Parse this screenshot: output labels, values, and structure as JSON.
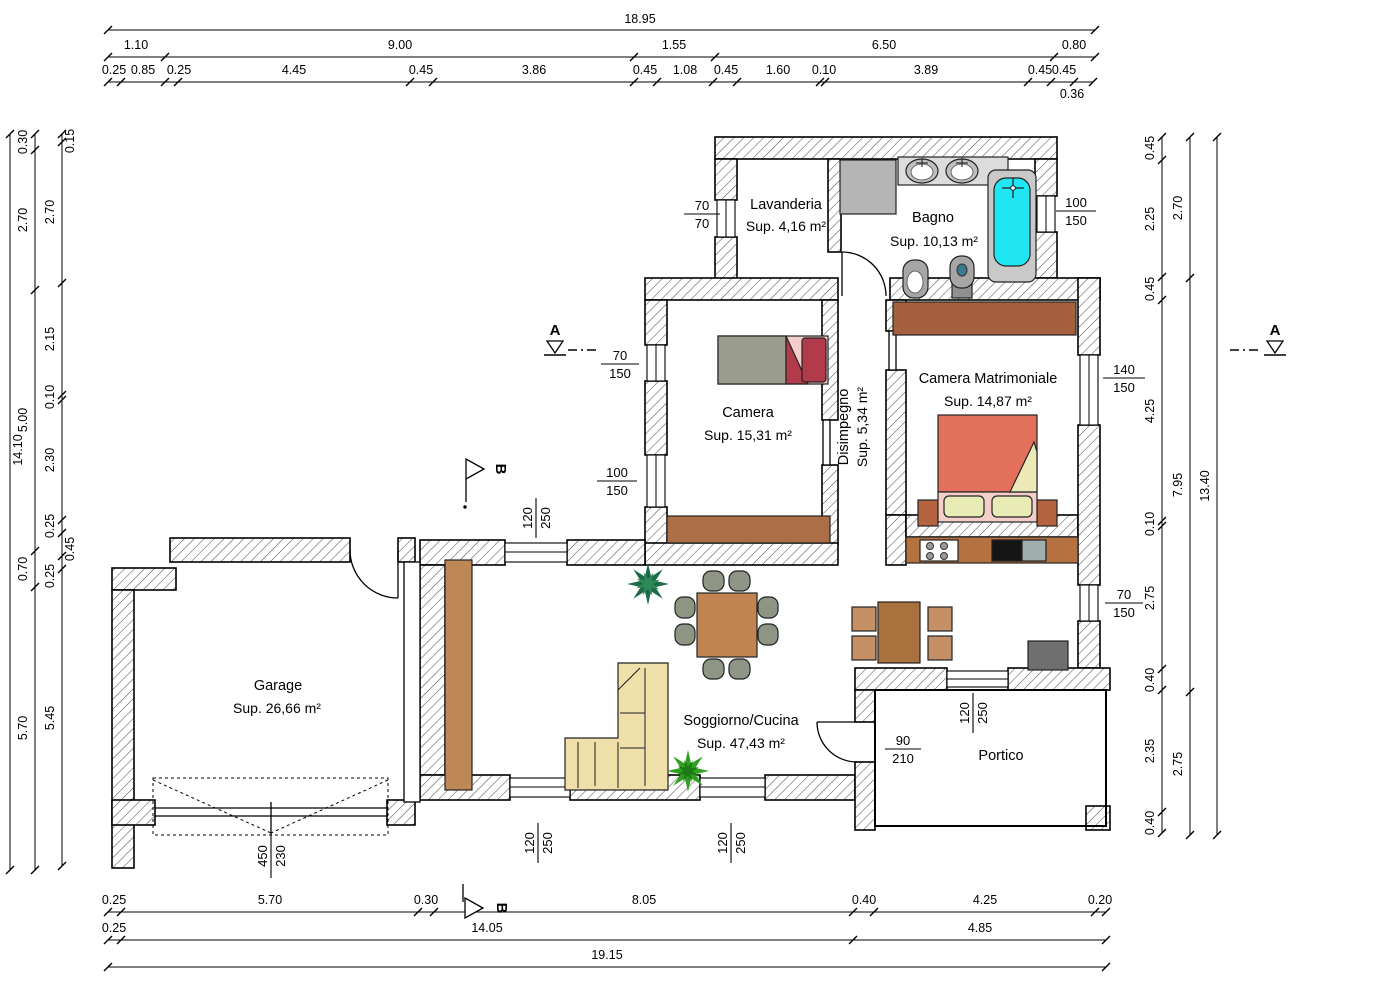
{
  "rooms": {
    "lavanderia": {
      "name": "Lavanderia",
      "area": "Sup. 4,16 m²"
    },
    "bagno": {
      "name": "Bagno",
      "area": "Sup. 10,13 m²"
    },
    "camera": {
      "name": "Camera",
      "area": "Sup. 15,31 m²"
    },
    "matrimoniale": {
      "name": "Camera Matrimoniale",
      "area": "Sup. 14,87 m²"
    },
    "disimpegno": {
      "name": "Disimpegno",
      "area": "Sup. 5,34 m²"
    },
    "garage": {
      "name": "Garage",
      "area": "Sup. 26,66 m²"
    },
    "soggiorno": {
      "name": "Soggiorno/Cucina",
      "area": "Sup. 47,43 m²"
    },
    "portico": {
      "name": "Portico"
    }
  },
  "openings": {
    "lavanderia_window": {
      "top": "70",
      "bottom": "70"
    },
    "bagno_window": {
      "top": "100",
      "bottom": "150"
    },
    "camera_window_upper": {
      "top": "70",
      "bottom": "150"
    },
    "camera_window_lower": {
      "top": "100",
      "bottom": "150"
    },
    "matrimoniale_window": {
      "top": "140",
      "bottom": "150"
    },
    "cucina_window": {
      "top": "70",
      "bottom": "150"
    },
    "soggiorno_window_top": {
      "top": "120",
      "bottom": "250"
    },
    "soggiorno_window_b1": {
      "top": "120",
      "bottom": "250"
    },
    "soggiorno_window_b2": {
      "top": "120",
      "bottom": "250"
    },
    "portico_window": {
      "top": "120",
      "bottom": "250"
    },
    "portico_door": {
      "top": "90",
      "bottom": "210"
    },
    "garage_door": {
      "top": "450",
      "bottom": "230"
    }
  },
  "dims": {
    "top": {
      "total": "18.95",
      "row2": [
        "1.10",
        "9.00",
        "1.55",
        "6.50",
        "0.80"
      ],
      "row3": [
        "0.25",
        "0.85",
        "0.25",
        "4.45",
        "0.45",
        "3.86",
        "0.45",
        "1.08",
        "0.45",
        "1.60",
        "0.10",
        "3.89",
        "0.45",
        "0.45"
      ],
      "row4": "0.36"
    },
    "bottom": {
      "row1": [
        "0.25",
        "5.70",
        "0.30",
        "8.05",
        "0.40",
        "4.25",
        "0.20"
      ],
      "row2": [
        "0.25",
        "14.05",
        "4.85"
      ],
      "total": "19.15"
    },
    "left": {
      "total": "14.10",
      "mid": [
        "0.30",
        "2.70",
        "5.00",
        "0.70",
        "5.70"
      ],
      "inner": [
        "0.15",
        "2.70",
        "2.15",
        "0.10",
        "2.30",
        "0.25",
        "0.45",
        "0.25",
        "5.45"
      ]
    },
    "right": {
      "total": "13.40",
      "mid": [
        "2.70",
        "7.95",
        "2.75"
      ],
      "inner": [
        "0.45",
        "2.25",
        "0.45",
        "4.25",
        "0.10",
        "2.75",
        "0.40",
        "2.35",
        "0.40"
      ]
    }
  },
  "markers": {
    "section_a": "A",
    "section_b": "B"
  }
}
